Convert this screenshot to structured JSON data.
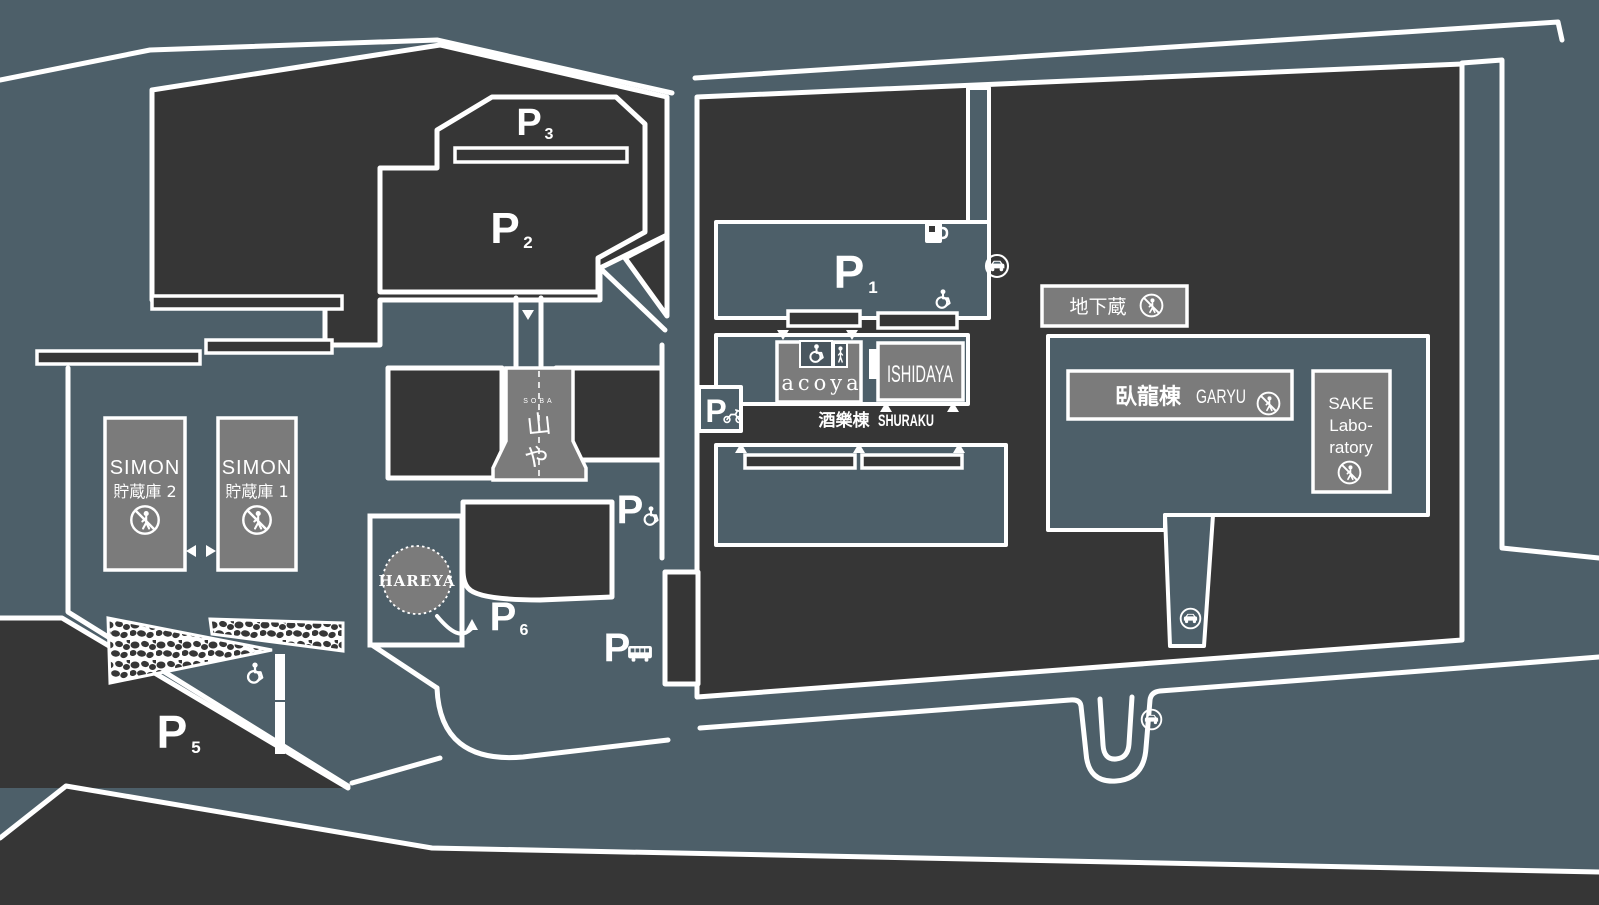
{
  "map": {
    "colors": {
      "background": "#4d5f69",
      "parcel": "#363636",
      "road": "#ffffff",
      "building": "#7b7b7b"
    },
    "parking": {
      "p1": {
        "p": "P",
        "num": "1"
      },
      "p2": {
        "p": "P",
        "num": "2"
      },
      "p3": {
        "p": "P",
        "num": "3"
      },
      "p5": {
        "p": "P",
        "num": "5"
      },
      "p6": {
        "p": "P",
        "num": "6"
      },
      "accessible": {
        "p": "P"
      },
      "bus": {
        "p": "P"
      },
      "motorcycle": {
        "p": "P"
      }
    },
    "buildings": {
      "simon_warehouse_2": {
        "name": "SIMON",
        "sub": "貯蔵庫 2"
      },
      "simon_warehouse_1": {
        "name": "SIMON",
        "sub": "貯蔵庫 1"
      },
      "hareya": {
        "name": "HAREYA"
      },
      "soba_shop": {
        "caption": "SOBA",
        "glyph1": "山",
        "glyph2": "や"
      },
      "acoya": {
        "name": "acoya"
      },
      "ishidaya": {
        "name": "ISHIDAYA"
      },
      "shuraku_building": {
        "jp": "酒樂棟",
        "en": "SHURAKU"
      },
      "underground_cellar": {
        "jp": "地下蔵"
      },
      "garyu_building": {
        "jp": "臥龍棟",
        "en": "GARYU"
      },
      "sake_laboratory": {
        "line1": "SAKE",
        "line2": "Labo-",
        "line3": "ratory"
      }
    }
  }
}
